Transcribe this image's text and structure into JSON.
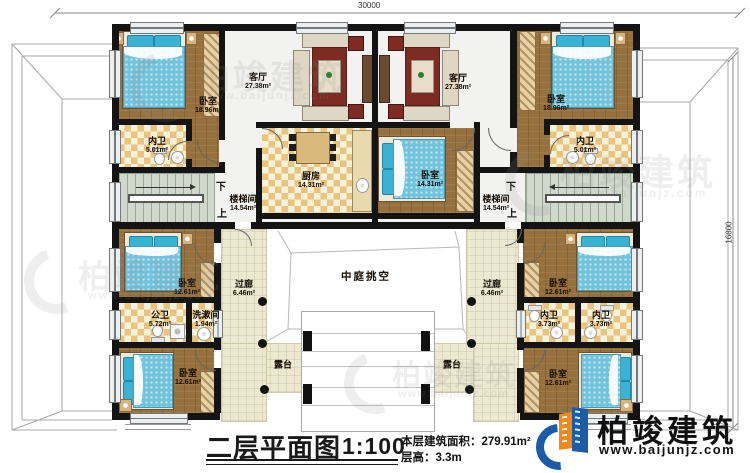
{
  "plan": {
    "dimensions": {
      "width": "30000",
      "height": "16800"
    },
    "stairs": {
      "down": "下",
      "up": "上"
    },
    "rooms": [
      {
        "label": "卧室",
        "area": "18.96m²"
      },
      {
        "label": "内卫",
        "area": "5.01m²"
      },
      {
        "label": "客厅",
        "area": "27.38m²"
      },
      {
        "label": "厨房",
        "area": "14.31m²"
      },
      {
        "label": "楼梯间",
        "area": "14.54m²"
      },
      {
        "label": "卧室",
        "area": "14.31m²"
      },
      {
        "label": "客厅",
        "area": "27.38m²"
      },
      {
        "label": "卧室",
        "area": "18.96m²"
      },
      {
        "label": "内卫",
        "area": "5.01m²"
      },
      {
        "label": "楼梯间",
        "area": "14.54m²"
      },
      {
        "label": "卧室",
        "area": "12.61m²"
      },
      {
        "label": "公卫",
        "area": "5.72m²"
      },
      {
        "label": "洗漱间",
        "area": "1.94m²"
      },
      {
        "label": "卧室",
        "area": "12.61m²"
      },
      {
        "label": "过廊",
        "area": "6.46m²"
      },
      {
        "label": "中庭挑空",
        "area": ""
      },
      {
        "label": "露台",
        "area": ""
      },
      {
        "label": "露台",
        "area": ""
      },
      {
        "label": "过廊",
        "area": "6.46m²"
      },
      {
        "label": "卧室",
        "area": "12.61m²"
      },
      {
        "label": "内卫",
        "area": "3.73m²"
      },
      {
        "label": "内卫",
        "area": "3.73m²"
      },
      {
        "label": "卧室",
        "area": "12.61m²"
      }
    ]
  },
  "titleblock": {
    "title": "二层平面图",
    "scale": "1:100",
    "area_label": "本层建筑面积：",
    "area_value": "279.91m²",
    "height_label": "层高：",
    "height_value": "3.3m"
  },
  "brand": {
    "name": "柏竣建筑",
    "url": "www.baijunjz.com"
  },
  "watermark": {
    "name": "柏竣建筑",
    "url": "www.baijunjz.com"
  }
}
